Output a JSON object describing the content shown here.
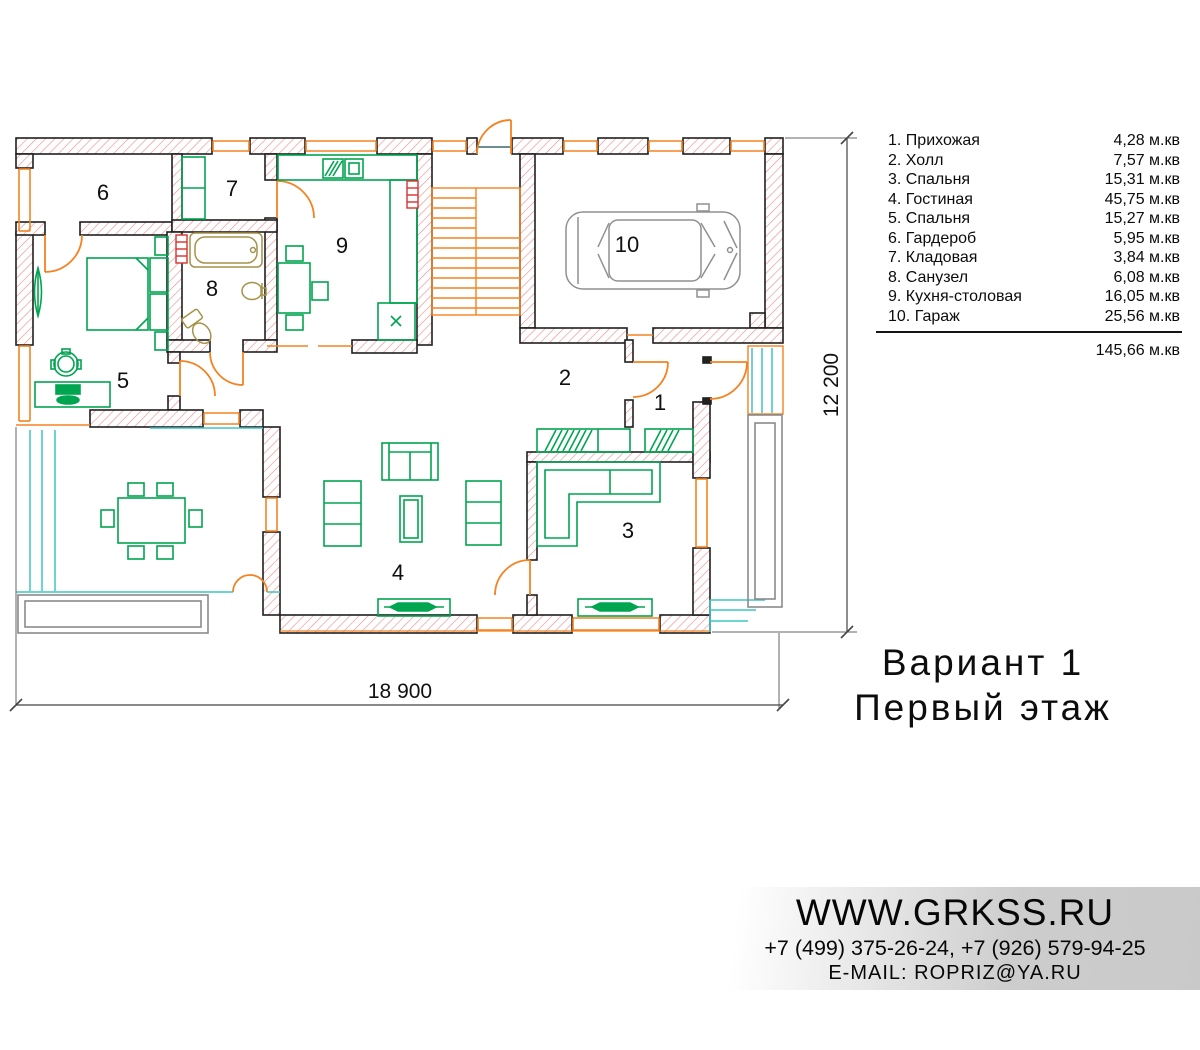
{
  "legend": {
    "rows": [
      {
        "label": "1. Прихожая",
        "area": "4,28 м.кв"
      },
      {
        "label": "2. Холл",
        "area": "7,57 м.кв"
      },
      {
        "label": "3. Спальня",
        "area": "15,31 м.кв"
      },
      {
        "label": "4. Гостиная",
        "area": "45,75 м.кв"
      },
      {
        "label": "5. Спальня",
        "area": "15,27 м.кв"
      },
      {
        "label": "6. Гардероб",
        "area": "5,95 м.кв"
      },
      {
        "label": "7. Кладовая",
        "area": "3,84 м.кв"
      },
      {
        "label": "8. Санузел",
        "area": "6,08 м.кв"
      },
      {
        "label": "9. Кухня-столовая",
        "area": "16,05 м.кв"
      },
      {
        "label": "10. Гараж",
        "area": "25,56 м.кв"
      }
    ],
    "total": "145,66 м.кв"
  },
  "plan": {
    "room_labels": [
      "1",
      "2",
      "3",
      "4",
      "5",
      "6",
      "7",
      "8",
      "9",
      "10"
    ]
  },
  "dimensions": {
    "width": "18 900",
    "height": "12 200"
  },
  "title": {
    "line1": "Вариант 1",
    "line2": "Первый этаж"
  },
  "footer": {
    "site": "WWW.GRKSS.RU",
    "phones": "+7 (499) 375-26-24, +7 (926) 579-94-25",
    "email": "E-MAIL: ROPRIZ@YA.RU"
  },
  "colors": {
    "wall_hatch": "#ef8a8a",
    "orange": "#f58220",
    "green": "#00a550",
    "teal": "#3fc6c0",
    "tan": "#a69249",
    "red": "#d93030",
    "gray": "#909090"
  }
}
